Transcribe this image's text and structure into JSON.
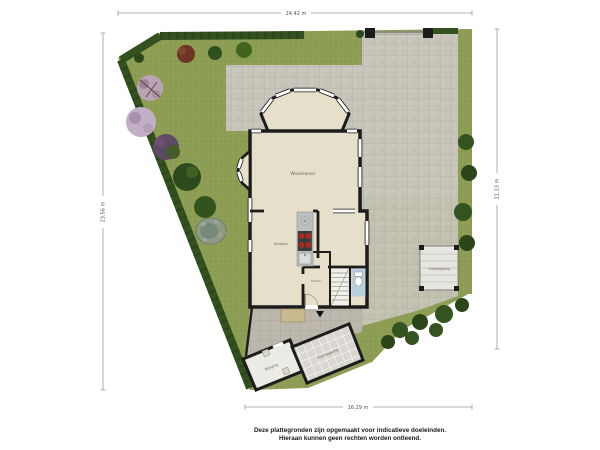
{
  "title": "Plattegrond begane grond met tuin",
  "dimensions": {
    "top": "24.42 m",
    "bottom": "16.29 m",
    "left": "23.56 m",
    "right": "21.13 m"
  },
  "rooms": {
    "woonkamer": "Woonkamer",
    "keuken": "Keuken",
    "entree": "Entree",
    "berging": "Berging",
    "canopy_bottom": "Overkapping",
    "canopy_right": "Overkapping"
  },
  "footer": {
    "line1": "Deze plattegronden zijn opgemaakt voor indicatieve doeleinden.",
    "line2": "Hieraan kunnen geen rechten worden ontleend."
  },
  "colors": {
    "grass": "#8d9d54",
    "grass_dark": "#7f9048",
    "hedge": "#33501f",
    "paving": "#c9c6bc",
    "paving_line": "#b0aca1",
    "terrace": "#bcb8ae",
    "floor": "#e6dfca",
    "wall": "#1c1c1c",
    "counter": "#b9bebe",
    "burner": "#c4281e",
    "wc_floor": "#b9cfdb",
    "structure_floor": "#eceae4",
    "canopy_floor": "#d8d6cf",
    "pond": "#8e9a86",
    "red_tree": "#6e3524",
    "pink_tree": "#b9a3b4",
    "lilac_tree": "#c3aec8",
    "purple_shrub": "#5f4a63",
    "tree_green": "#33531f",
    "dim_line": "#9a9a9a",
    "dim_text": "#555555",
    "label_text": "#6f6456",
    "footer_text": "#1a1a1a"
  }
}
